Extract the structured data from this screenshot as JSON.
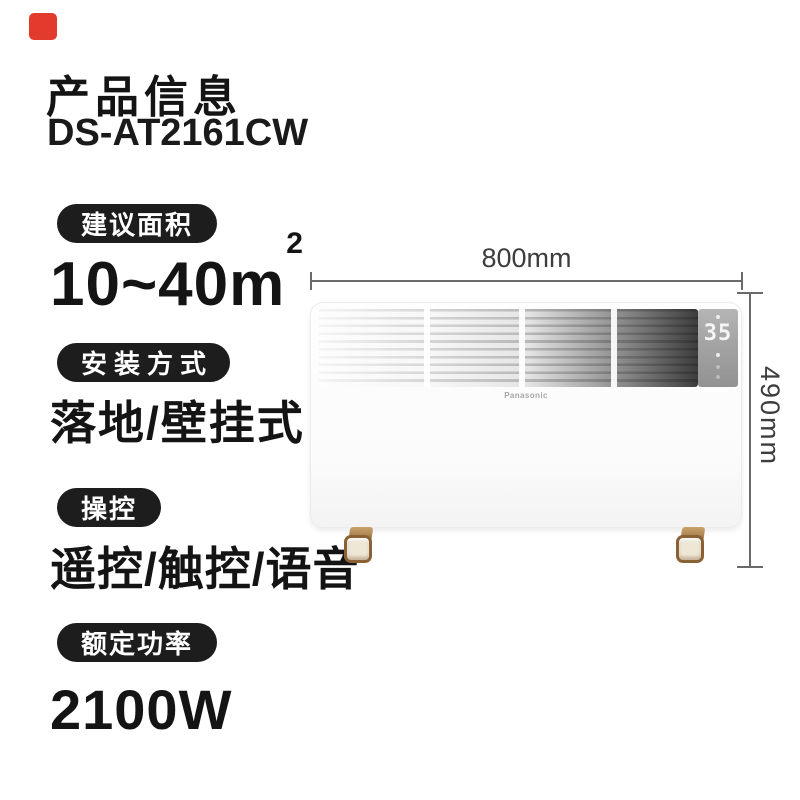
{
  "header": {
    "title": "产品信息",
    "model": "DS-AT2161CW"
  },
  "specs": [
    {
      "label": "建议面积",
      "value": "10~40m",
      "sup": "2"
    },
    {
      "label": "安装方式",
      "value": "落地/壁挂式"
    },
    {
      "label": "操控",
      "value": "遥控/触控/语音"
    },
    {
      "label": "额定功率",
      "value": "2100W"
    }
  ],
  "product": {
    "brand": "Panasonic",
    "display_temp": "35",
    "width_label": "800mm",
    "height_label": "490mm"
  },
  "colors": {
    "accent_red": "#e23a2c",
    "badge_bg": "#1d1d1d",
    "text": "#141414",
    "dimension_line": "#6a6a6a",
    "foot_bronze": "#8a6134"
  }
}
